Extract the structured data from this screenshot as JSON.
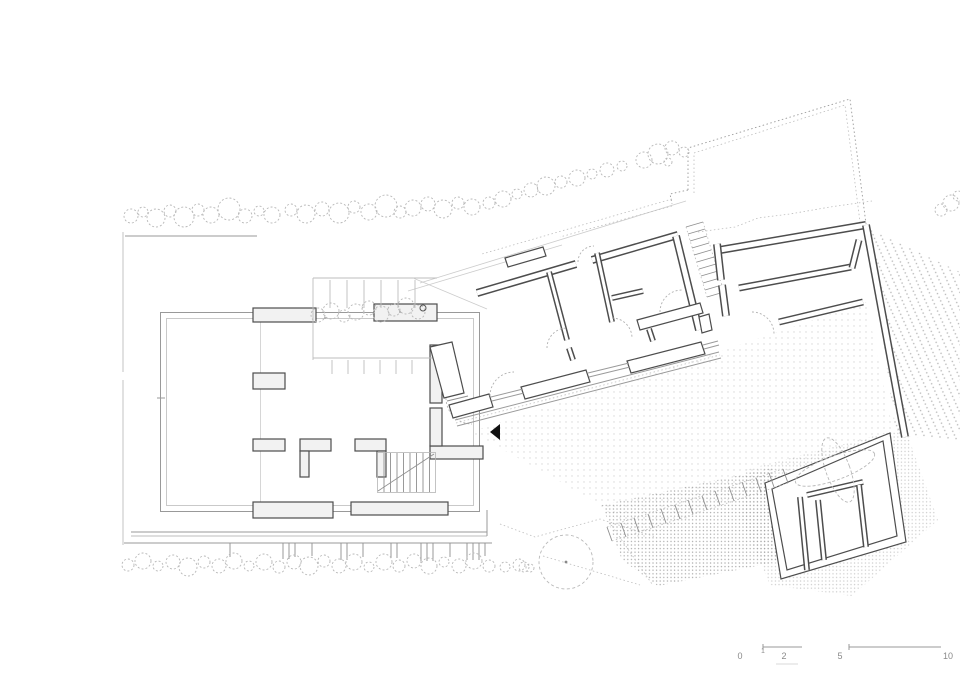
{
  "plan": {
    "scale_bar": {
      "labels": [
        "0",
        "1",
        "2",
        "5",
        "10"
      ]
    },
    "colors": {
      "background": "#ffffff",
      "wall": "#4d4d4d",
      "thin_line": "#9a9a9a",
      "vegetation": "#b8b8b8",
      "stipple": "#a5a5a5",
      "entrance_marker": "#111111"
    },
    "features": [
      "left-building",
      "pergola-canopy",
      "entrance-vestibule",
      "bedroom-wing",
      "terrace-stair",
      "court-enclosure",
      "outbuilding",
      "garden-steps",
      "tree-row-top",
      "hedge-bottom",
      "court-hedge",
      "round-tree",
      "property-boundary",
      "gravel-stipple",
      "scale-bar",
      "entrance-arrow"
    ]
  }
}
